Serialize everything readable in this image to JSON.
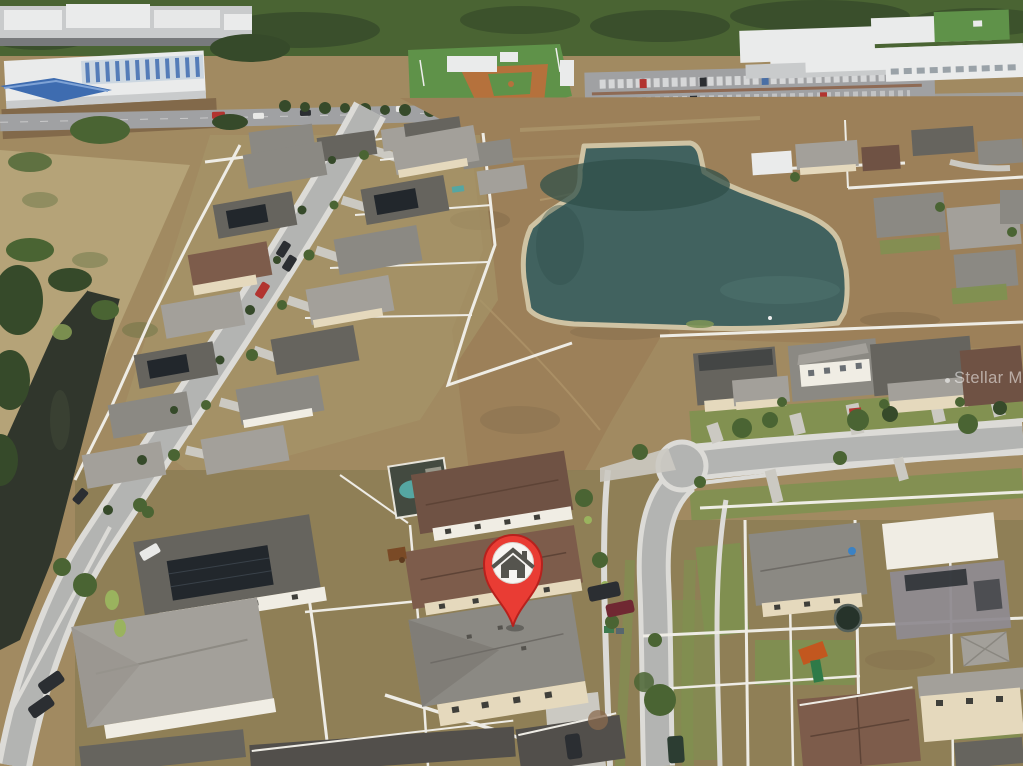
{
  "photo": {
    "kind": "aerial drone photograph",
    "caption": "Aerial view of a Florida suburban neighborhood with a retention pond, baseball field and commercial buildings at top, rows of single-family homes, and a subject property marked with a red pin"
  },
  "watermark": {
    "text": "Stellar MLS"
  },
  "marker": {
    "type": "map-pin",
    "icon": "house-icon",
    "meaning": "subject property location"
  },
  "scene": {
    "regions": [
      "city skyline",
      "industrial warehouses",
      "blue canopy",
      "highway with cars",
      "baseball field",
      "parking lot full of cars",
      "commercial buildings",
      "tree line",
      "retention pond",
      "vacant dirt lot",
      "white vinyl fences",
      "diagonal residential street",
      "rows of single-family homes",
      "roof solar panels",
      "drainage canal",
      "dry field",
      "screened pool enclosure",
      "cul-de-sac",
      "curved street",
      "backyards",
      "trampoline",
      "playset",
      "shed",
      "street trees and palms",
      "parked cars",
      "subject property"
    ]
  },
  "colors": {
    "base": "#a18a61",
    "dirt": "#9c8059",
    "dirt_light": "#b49a6e",
    "dirt_dark": "#82694a",
    "yard": "#8d7d55",
    "field": "#b5a378",
    "pond": "#41625f",
    "pond_dark": "#30504a",
    "pond_rim": "#cfc3a3",
    "canal": "#30362c",
    "road": "#b3b4b2",
    "asphalt": "#a0a1a3",
    "sidewalk": "#dcdbd7",
    "drive": "#cbc9c2",
    "roof_gray": "#8b8983",
    "roof_gray_light": "#a3a09a",
    "roof_gray_dark": "#66645e",
    "roof_brown": "#6f5244",
    "roof_brown2": "#7d5c4b",
    "roof_charcoal": "#524f4b",
    "wall": "#e5d9bd",
    "wall_white": "#f0ede4",
    "fence": "#eeece5",
    "solar": "#22272c",
    "tree": "#4a6433",
    "tree_dark": "#364a2a",
    "lawn": "#7e9150",
    "lawn_bright": "#9ab35e",
    "ball_green": "#5f9249",
    "clay": "#b5713c",
    "bldg_white": "#eaebeb",
    "bldg_shade": "#c9cbcc",
    "bldg_blue": "#3e6cb0",
    "blue_panel": "#ccd7e1",
    "pool": "#55a6a2",
    "pin_red": "#e93c34",
    "pin_red_dark": "#b7211d",
    "pin_white": "#f7f5f2",
    "pin_icon": "#55544e",
    "car_dark": "#2b2e32",
    "car_white": "#e9e9e7",
    "car_red": "#b23430",
    "car_maroon": "#702832",
    "car_green": "#2c3d32",
    "watermark": "#ffffff"
  }
}
